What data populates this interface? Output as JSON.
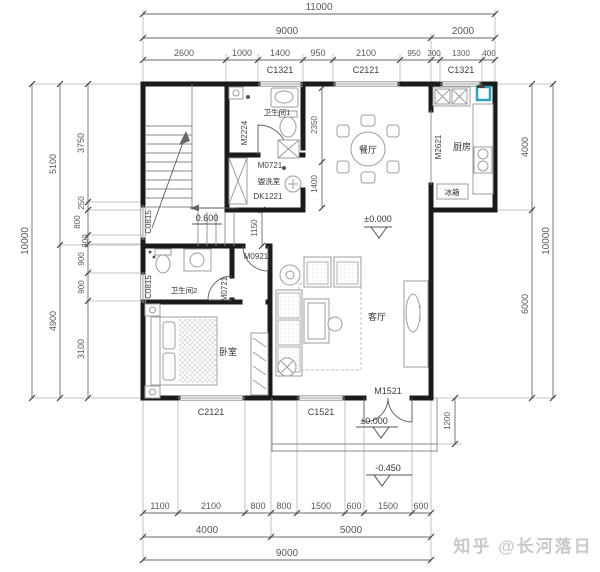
{
  "watermark": "知乎 @长河落日",
  "colors": {
    "wall": "#1b1b1b",
    "dimension": "#585858",
    "furniture": "#9c9c9c",
    "window": "#9c9c9c",
    "highlight": "#2aa6bc",
    "watermark": "#c9c9c9",
    "background": "#ffffff"
  },
  "dims": {
    "top": {
      "total": "11000",
      "left": "9000",
      "right": "2000",
      "segs": [
        "2600",
        "1000",
        "1400",
        "950",
        "2100",
        "950",
        "300",
        "1300",
        "400"
      ]
    },
    "bottom": {
      "segs": [
        "1100",
        "2100",
        "800",
        "800",
        "1500",
        "600",
        "1500",
        "600"
      ],
      "left": "4000",
      "right": "5000",
      "total": "9000"
    },
    "left": {
      "total": "10000",
      "upper": "5100",
      "lower": "4900",
      "segs": [
        "3750",
        "250",
        "800",
        "300",
        "900",
        "900",
        "3100"
      ]
    },
    "right": {
      "total": "10000",
      "upper": "4000",
      "lower": "6000",
      "porch": "1200"
    },
    "interior": {
      "dining_upper": "2350",
      "dining_lower": "1400",
      "hall": "1150"
    }
  },
  "windows": {
    "top": [
      "C1321",
      "C2121",
      "C1321"
    ],
    "bottom": [
      "C2121",
      "C1521"
    ],
    "left": [
      "C0815",
      "C0815"
    ]
  },
  "doors": {
    "bath1": "M2224",
    "laundry": "M0721",
    "laundry_opening": "DK1221",
    "kitchen": "M2621",
    "hall": "M0921",
    "bath2": "M0721",
    "entry": "M1521"
  },
  "rooms": {
    "bath1": "卫生间1",
    "dining": "餐厅",
    "kitchen": "厨房",
    "fridge": "冰箱",
    "laundry": "盥洗室",
    "bath2": "卫生间2",
    "bedroom": "卧室",
    "living": "客厅"
  },
  "levels": {
    "main": "±0.000",
    "stair": "0.600",
    "porch": "±0.000",
    "outside": "-0.450"
  }
}
